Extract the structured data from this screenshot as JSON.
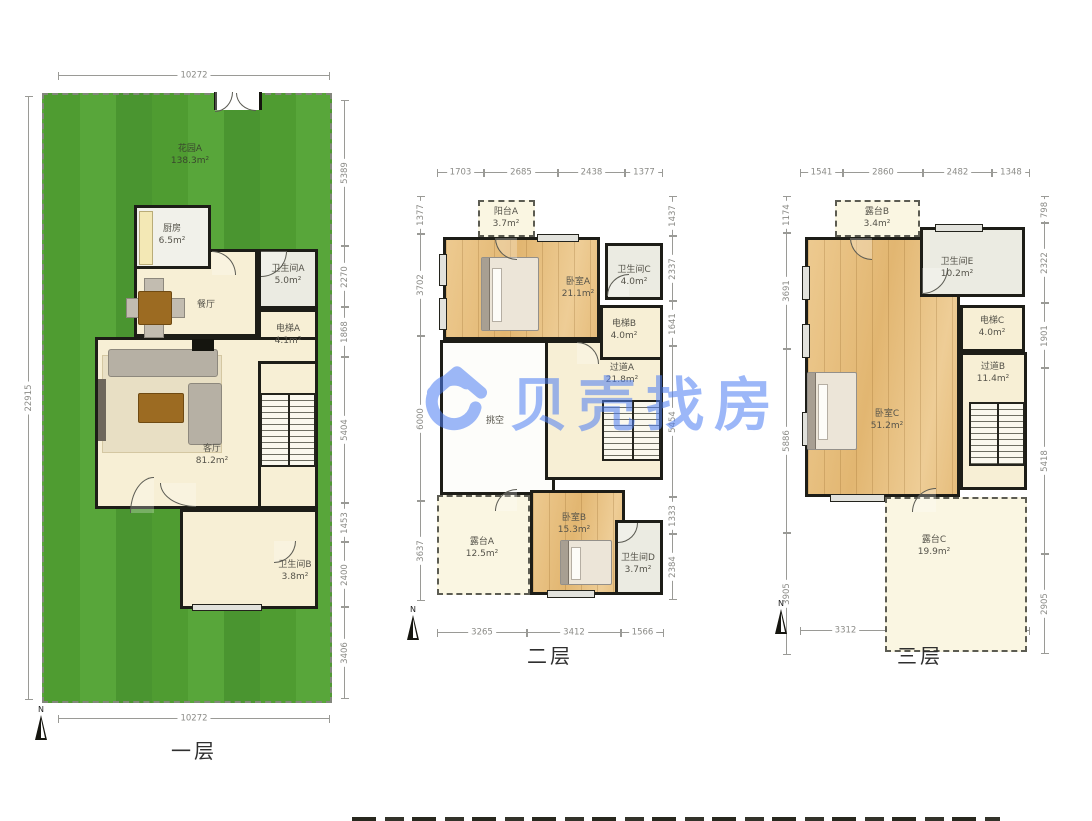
{
  "watermark": {
    "text": "贝壳找房",
    "color": "#4d7ef3"
  },
  "compass_label": "N",
  "floors": [
    {
      "title": "一层",
      "rooms": [
        {
          "id": "garden",
          "name": "花园A",
          "area": "138.3m²"
        },
        {
          "id": "dining",
          "name": "餐厅",
          "area": ""
        },
        {
          "id": "kitchen",
          "name": "厨房",
          "area": "6.5m²"
        },
        {
          "id": "bathA",
          "name": "卫生间A",
          "area": "5.0m²"
        },
        {
          "id": "elevA",
          "name": "电梯A",
          "area": "4.1m²"
        },
        {
          "id": "living",
          "name": "客厅",
          "area": "81.2m²"
        },
        {
          "id": "bathB",
          "name": "卫生间B",
          "area": "3.8m²"
        }
      ],
      "dims": {
        "top": [
          "10272"
        ],
        "bottom": [
          "10272"
        ],
        "left": [
          "22915"
        ],
        "right": [
          "5389",
          "2270",
          "1868",
          "5404",
          "1453",
          "2400",
          "3406"
        ]
      }
    },
    {
      "title": "二层",
      "rooms": [
        {
          "id": "void",
          "name": "挑空",
          "area": ""
        },
        {
          "id": "hallA",
          "name": "过道A",
          "area": "21.8m²"
        },
        {
          "id": "bedA",
          "name": "卧室A",
          "area": "21.1m²"
        },
        {
          "id": "balcA",
          "name": "阳台A",
          "area": "3.7m²"
        },
        {
          "id": "bathC",
          "name": "卫生间C",
          "area": "4.0m²"
        },
        {
          "id": "elevB",
          "name": "电梯B",
          "area": "4.0m²"
        },
        {
          "id": "terrA",
          "name": "露台A",
          "area": "12.5m²"
        },
        {
          "id": "bedB",
          "name": "卧室B",
          "area": "15.3m²"
        },
        {
          "id": "bathD",
          "name": "卫生间D",
          "area": "3.7m²"
        }
      ],
      "dims": {
        "top": [
          "1703",
          "2685",
          "2438",
          "1377"
        ],
        "left": [
          "1377",
          "3702",
          "6000",
          "3637"
        ],
        "right": [
          "1437",
          "2337",
          "1641",
          "5454",
          "1333",
          "2384"
        ],
        "bottom": [
          "3265",
          "3412",
          "1566"
        ]
      }
    },
    {
      "title": "三层",
      "rooms": [
        {
          "id": "bedC",
          "name": "卧室C",
          "area": "51.2m²"
        },
        {
          "id": "hallB",
          "name": "过道B",
          "area": "11.4m²"
        },
        {
          "id": "terrB",
          "name": "露台B",
          "area": "3.4m²"
        },
        {
          "id": "bathE",
          "name": "卫生间E",
          "area": "10.2m²"
        },
        {
          "id": "elevC",
          "name": "电梯C",
          "area": "4.0m²"
        },
        {
          "id": "terrC",
          "name": "露台C",
          "area": "19.9m²"
        }
      ],
      "dims": {
        "top": [
          "1541",
          "2860",
          "2482",
          "1348"
        ],
        "left": [
          "1174",
          "3691",
          "5886",
          "3905"
        ],
        "right": [
          "798",
          "2322",
          "1901",
          "5418",
          "2905"
        ],
        "bottom": [
          "3312",
          "5099"
        ]
      }
    }
  ]
}
